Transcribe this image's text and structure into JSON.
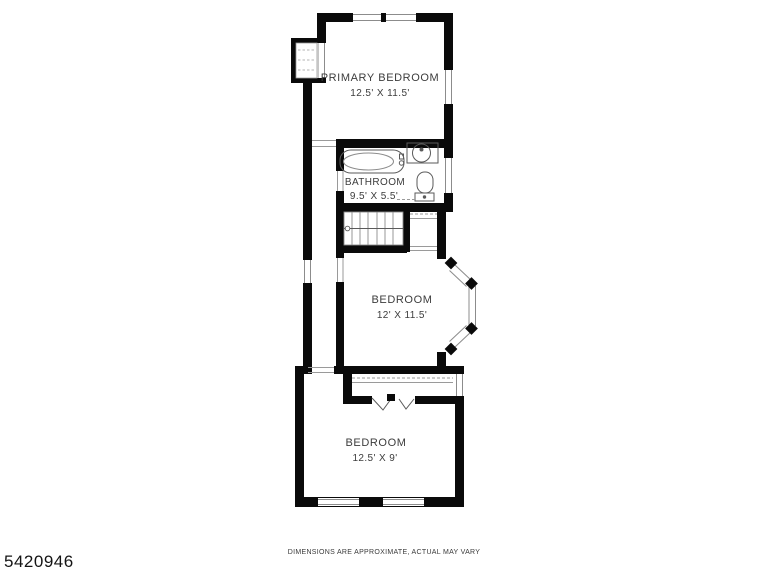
{
  "page": {
    "background": "#ffffff",
    "footer": {
      "listing_id": "5420946",
      "disclaimer": "DIMENSIONS ARE APPROXIMATE, ACTUAL MAY VARY"
    }
  },
  "floorplan": {
    "colors": {
      "wall": "#0a0a0a",
      "thin_line": "#8c8c8c",
      "fixture_line": "#5a5a5a",
      "label_text": "#3c3c3c"
    },
    "rooms": [
      {
        "id": "primary-bedroom",
        "label": "PRIMARY BEDROOM",
        "dimensions": "12.5' X 11.5'"
      },
      {
        "id": "bathroom",
        "label": "BATHROOM",
        "dimensions": "9.5' X 5.5'"
      },
      {
        "id": "bedroom-middle",
        "label": "BEDROOM",
        "dimensions": "12' X 11.5'"
      },
      {
        "id": "bedroom-rear",
        "label": "BEDROOM",
        "dimensions": "12.5' X 9'"
      }
    ],
    "fixtures": [
      "bathtub",
      "sink",
      "toilet",
      "staircase",
      "bay-window",
      "closet-rod",
      "bifold-door",
      "window",
      "door-opening"
    ]
  }
}
